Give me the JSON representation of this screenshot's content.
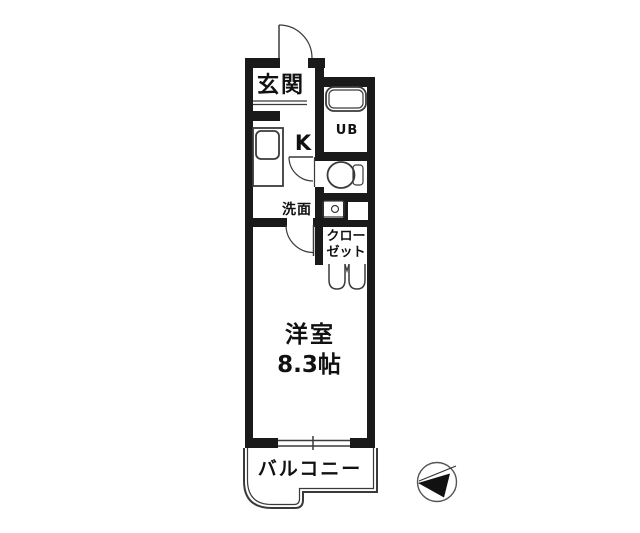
{
  "colors": {
    "wall": "#1a1a1a",
    "thin_line": "#3a3a3a",
    "text": "#111111",
    "background": "#ffffff",
    "compass_fill": "#111111"
  },
  "floor_plan": {
    "rooms": {
      "entrance": {
        "label": "玄関"
      },
      "kitchen": {
        "label": "K"
      },
      "unit_bath": {
        "label": "UB"
      },
      "washroom": {
        "label": "洗面"
      },
      "closet": {
        "label": "クローゼット",
        "label_lines": [
          "クロー",
          "ゼット"
        ]
      },
      "western_room": {
        "label": "洋室",
        "size": "8.3帖"
      },
      "balcony": {
        "label": "バルコニー"
      }
    },
    "icons": {
      "compass": "north-arrow-compass"
    }
  }
}
